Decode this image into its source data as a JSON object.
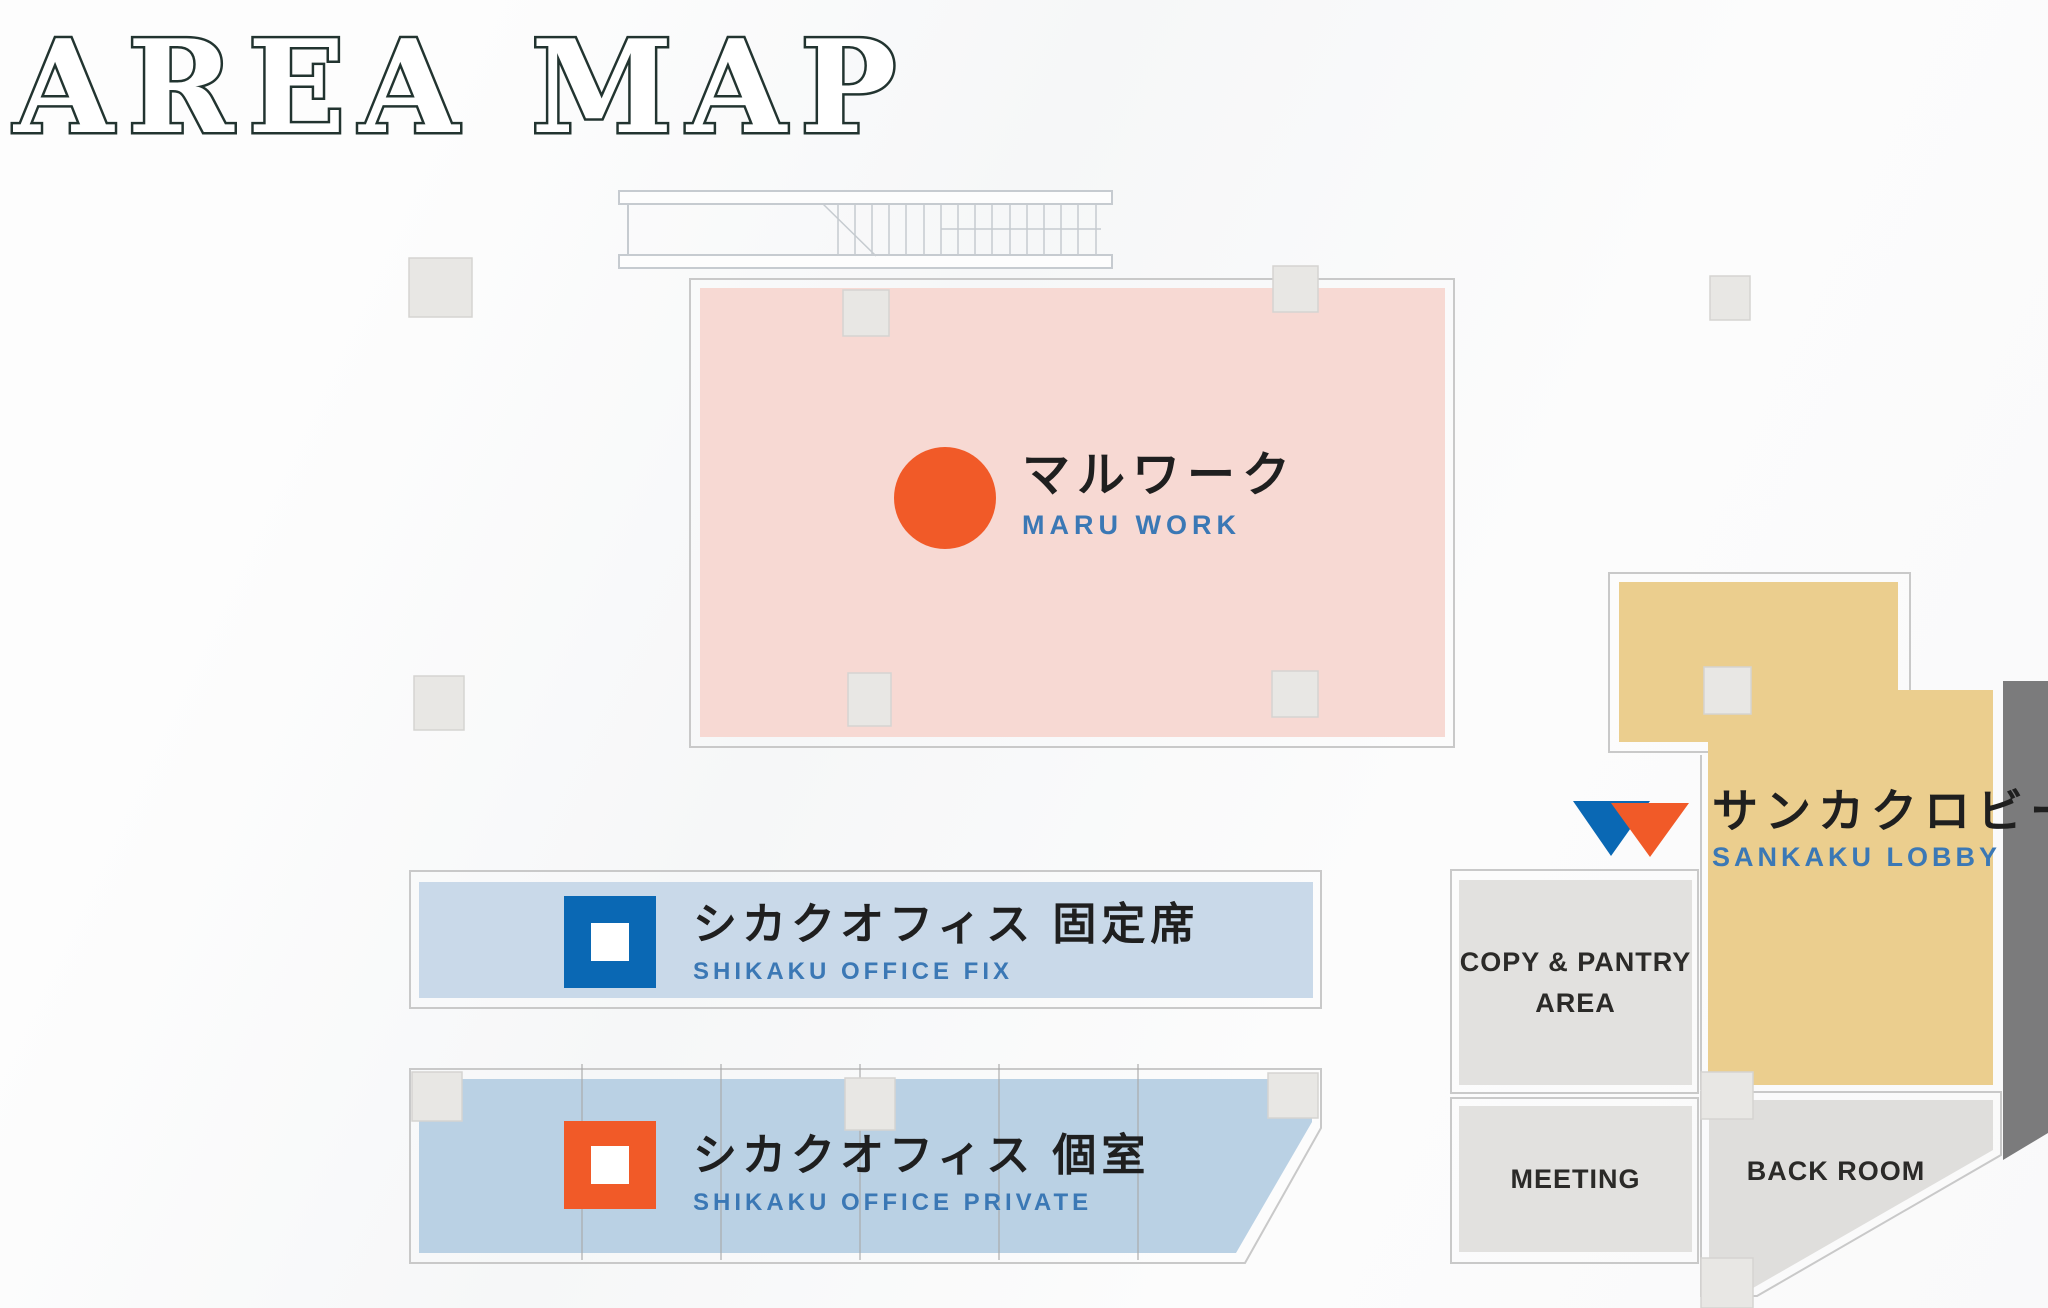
{
  "title": "AREA MAP",
  "areas": {
    "maru_work": {
      "name_jp": "マルワーク",
      "name_en": "MARU WORK"
    },
    "shikaku_office_fix": {
      "name_jp": "シカクオフィス 固定席",
      "name_en": "SHIKAKU OFFICE FIX"
    },
    "shikaku_office_private": {
      "name_jp": "シカクオフィス 個室",
      "name_en": "SHIKAKU OFFICE PRIVATE"
    },
    "sankaku_lobby": {
      "name_jp": "サンカクロビー",
      "name_en": "SANKAKU LOBBY"
    },
    "copy_pantry_area": {
      "label_line1": "COPY & PANTRY",
      "label_line2": "AREA"
    },
    "meeting": {
      "label": "MEETING"
    },
    "back_room": {
      "label": "BACK ROOM"
    }
  },
  "icons": {
    "maru": "orange-circle-icon",
    "shikaku_fix": "blue-square-icon",
    "shikaku_private": "orange-square-icon",
    "sankaku": "blue-and-orange-triangles-icon"
  },
  "colors": {
    "accent-orange": "#F15A28",
    "accent-blue": "#0A68B4",
    "text-dark": "#1F1F1F",
    "text-blue": "#3B78B5",
    "maru-pink": "#F7D9D3",
    "band-fix-blue": "#C9D9E9",
    "band-private-blue": "#BAD1E4",
    "lobby-tan": "#EBCE8E",
    "room-gray": "#E2E1DF",
    "backroom-gray": "#DFDEDC",
    "dark-gray": "#7B7B7C",
    "pillar-gray": "#E8E7E4",
    "pillar-border": "#D5D4D1",
    "outline-gray": "#C9C9C9",
    "stair-line": "#C6CBD0",
    "title-outline": "#223430"
  }
}
